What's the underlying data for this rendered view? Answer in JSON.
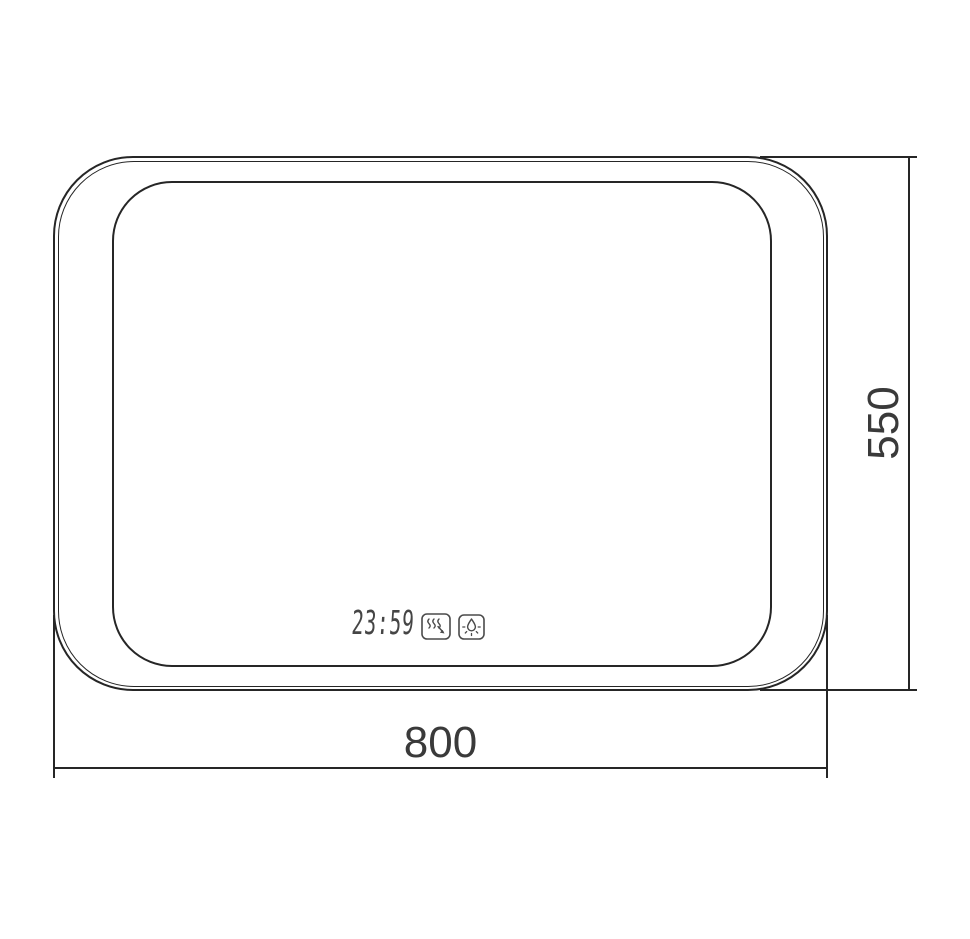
{
  "drawing": {
    "type": "technical-dimension-drawing",
    "subject": "rounded-rectangle mirror with LED zone and clock display"
  },
  "labels": {
    "width": "800",
    "height": "550"
  },
  "display": {
    "time": "23:59"
  },
  "icons": [
    {
      "name": "defog-icon"
    },
    {
      "name": "light-drop-icon"
    }
  ],
  "colors": {
    "line": "#262626",
    "text": "#3a3a3a",
    "display": "#454545",
    "background": "#ffffff"
  }
}
